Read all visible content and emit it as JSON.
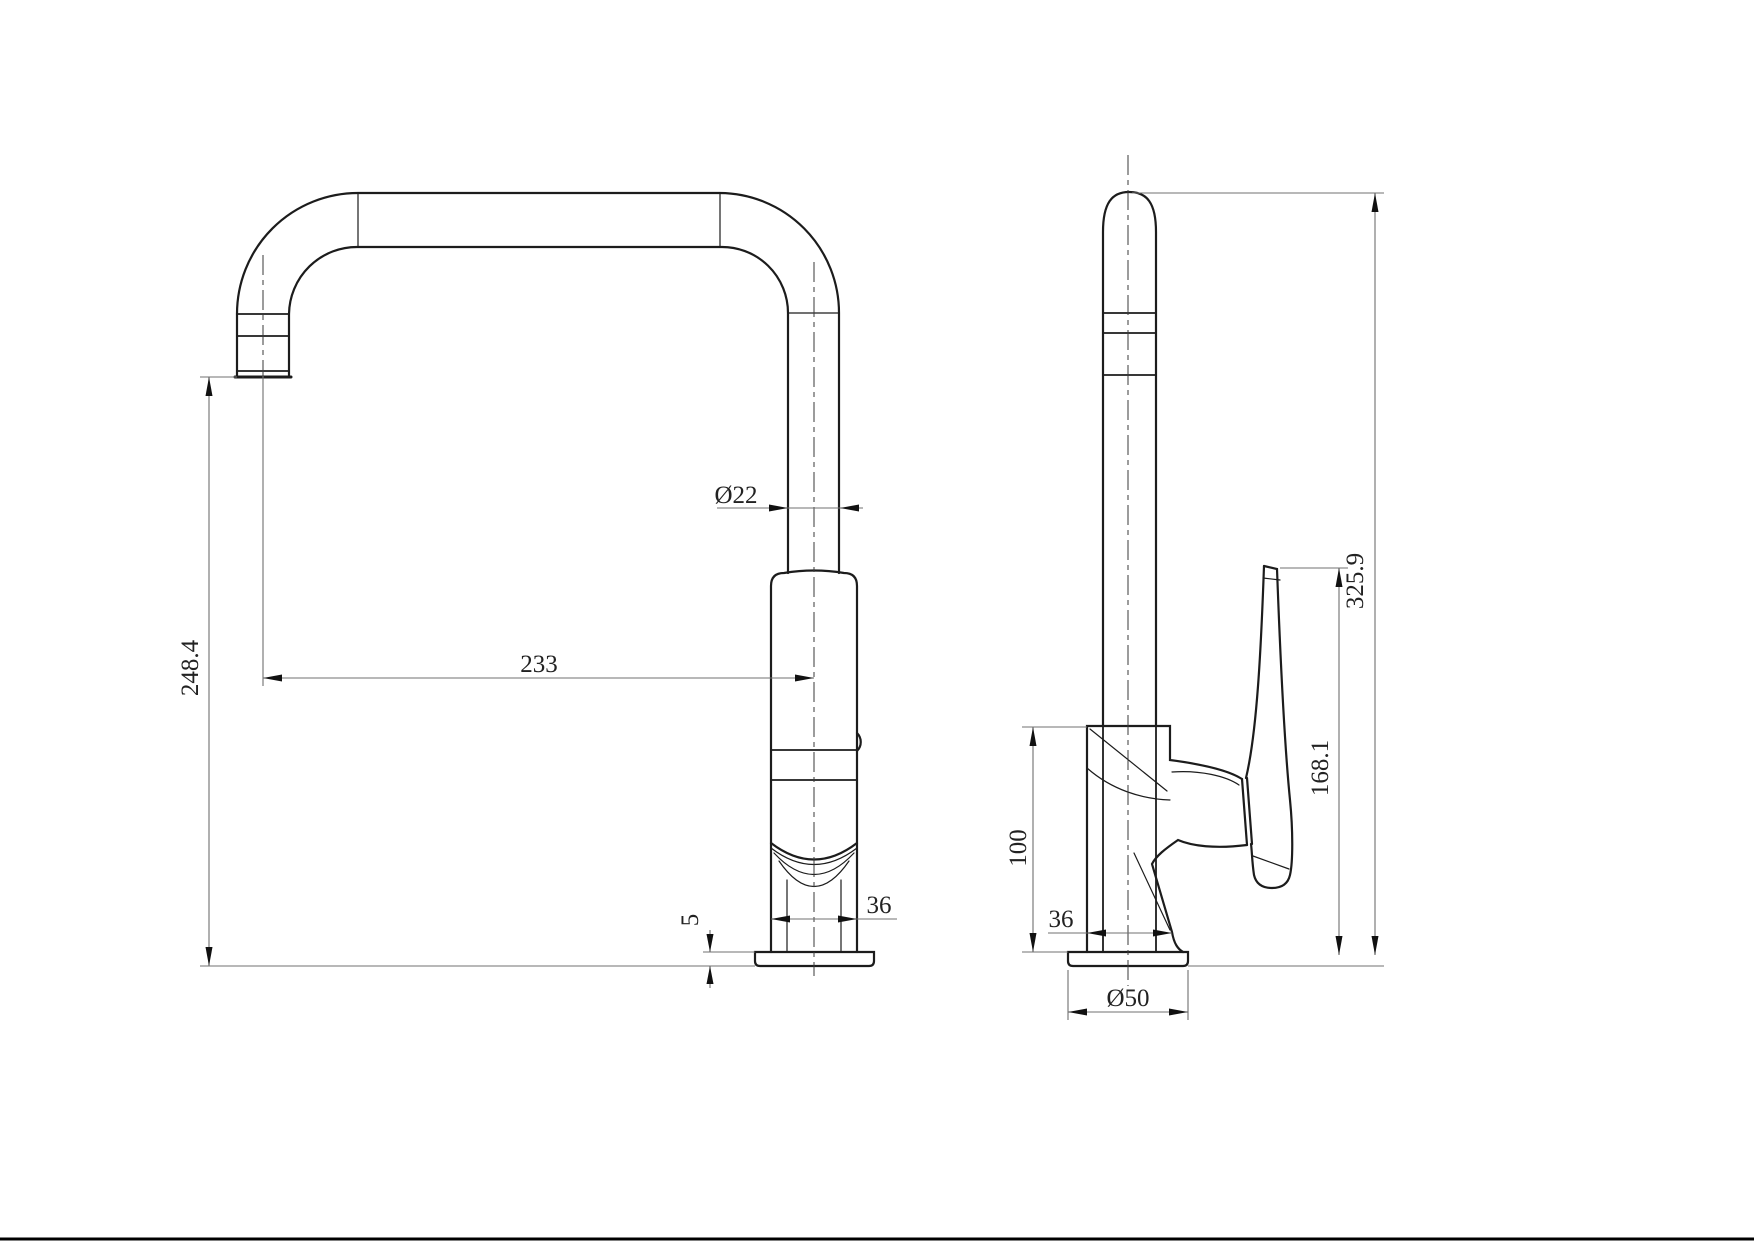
{
  "drawing": {
    "kind": "kitchen-faucet-orthographic-drawing",
    "colors": {
      "background": "#ffffff",
      "object_line": "#1c1c1c",
      "dimension_line": "#707070",
      "text": "#222222"
    },
    "front_view": {
      "dims": {
        "spout_height": "248.4",
        "spout_reach": "233",
        "pipe_diameter": "Ø22",
        "body_width": "36",
        "base_thickness": "5"
      }
    },
    "side_view": {
      "dims": {
        "body_height": "100",
        "body_width": "36",
        "base_diameter": "Ø50",
        "handle_height": "168.1",
        "total_height": "325.9"
      }
    }
  }
}
